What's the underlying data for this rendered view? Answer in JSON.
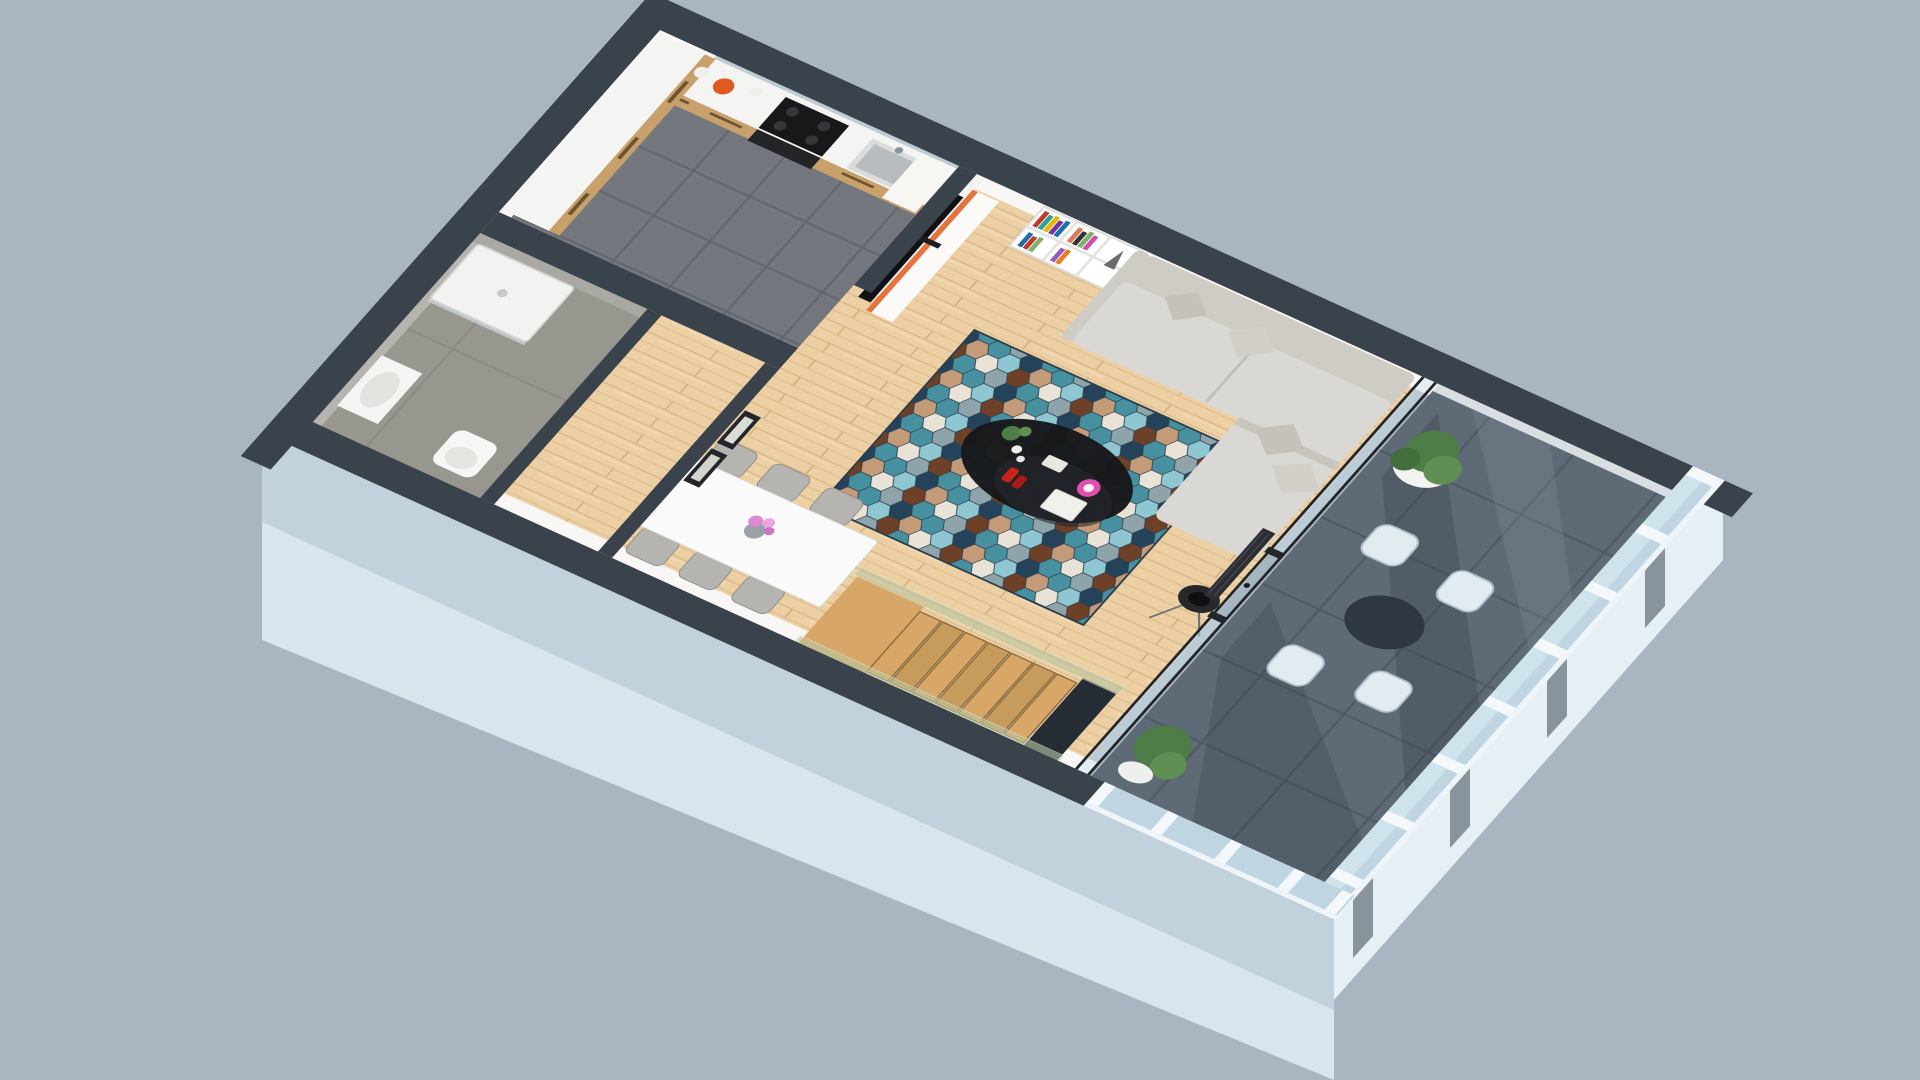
{
  "scene": {
    "type": "3d-floor-plan-render",
    "view": "isometric-top-down-apartment",
    "palette": {
      "background": "#a9b5c0",
      "wall_top": "#3a424c",
      "wall_face": "#f8f7f5",
      "exterior_face": "#c2d2dd",
      "exterior_face_light": "#d9e5ec",
      "kitchen_tile": "#73777d",
      "wood_floor": "#ecd0a4",
      "balcony_tile": "#5e6a75",
      "bathroom_floor": "#97968f",
      "concrete_wall": "#a9a8a3",
      "sofa": "#dad8d4",
      "sofa_back": "#cfccc6",
      "rug_teal": "#47909f",
      "rug_navy": "#24425a",
      "rug_brown": "#6e4027",
      "rug_tan": "#c49b78",
      "rug_cream": "#e9e3d7",
      "rug_ltblue": "#8ec6d2",
      "rug_gray": "#8fa3ab",
      "cabinet_wood": "#c8a06c",
      "counter": "#f4f4f2",
      "accent_orange": "#e05a20",
      "stairs_wood": "#d8a768",
      "stairs_wood_dark": "#c79b5c",
      "glass": "#cfe3ed",
      "glass_green": "#b9c7a2",
      "table_white": "#fafafa",
      "chair_gray": "#b6b4b1",
      "balcony_chair": "#e2ebf0",
      "plant_green": "#4e7d47",
      "lamp_black": "#26282c",
      "coffee_table": "#17181b",
      "frame_dark": "#2a2c30",
      "tv_black": "#101114",
      "appliance_black": "#17181a"
    },
    "rooms": [
      {
        "id": "kitchen",
        "floor": "dark-gray-tile"
      },
      {
        "id": "bathroom",
        "floor": "concrete"
      },
      {
        "id": "entry-hall",
        "floor": "wood"
      },
      {
        "id": "living-room",
        "floor": "wood"
      },
      {
        "id": "dining-area",
        "floor": "wood"
      },
      {
        "id": "staircase",
        "floor": "wood-steps-glass-rail"
      },
      {
        "id": "balcony-terrace",
        "floor": "dark-tile"
      }
    ],
    "furniture": {
      "kitchen": [
        "l-shaped-wood-cabinets",
        "white-countertop",
        "black-cooktop",
        "oven",
        "sink",
        "orange-canister",
        "glass-backsplash",
        "tall-white-cabinet"
      ],
      "living_room": [
        "tv-on-media-bench",
        "white-cube-bookshelf-with-colorful-books",
        "eiffel-figurine",
        "l-shaped-gray-sofa",
        "pillows",
        "hexagon-pattern-rug",
        "black-organic-coffee-table",
        "magazines",
        "red-shoes",
        "floor-lamp-tripod",
        "wall-art-sketch",
        "radiator"
      ],
      "dining_area": [
        "white-dining-table",
        "six-gray-chairs",
        "vase-with-pink-flowers",
        "two-framed-bw-pictures"
      ],
      "bathroom": [
        "shower-tray",
        "washbasin",
        "toilet"
      ],
      "balcony": [
        "white-cylinder-planter-with-tree",
        "round-dark-table",
        "four-light-armchairs",
        "green-bush-planter",
        "glazed-facade"
      ],
      "staircase": [
        "wood-steps",
        "glass-balustrade"
      ]
    }
  }
}
